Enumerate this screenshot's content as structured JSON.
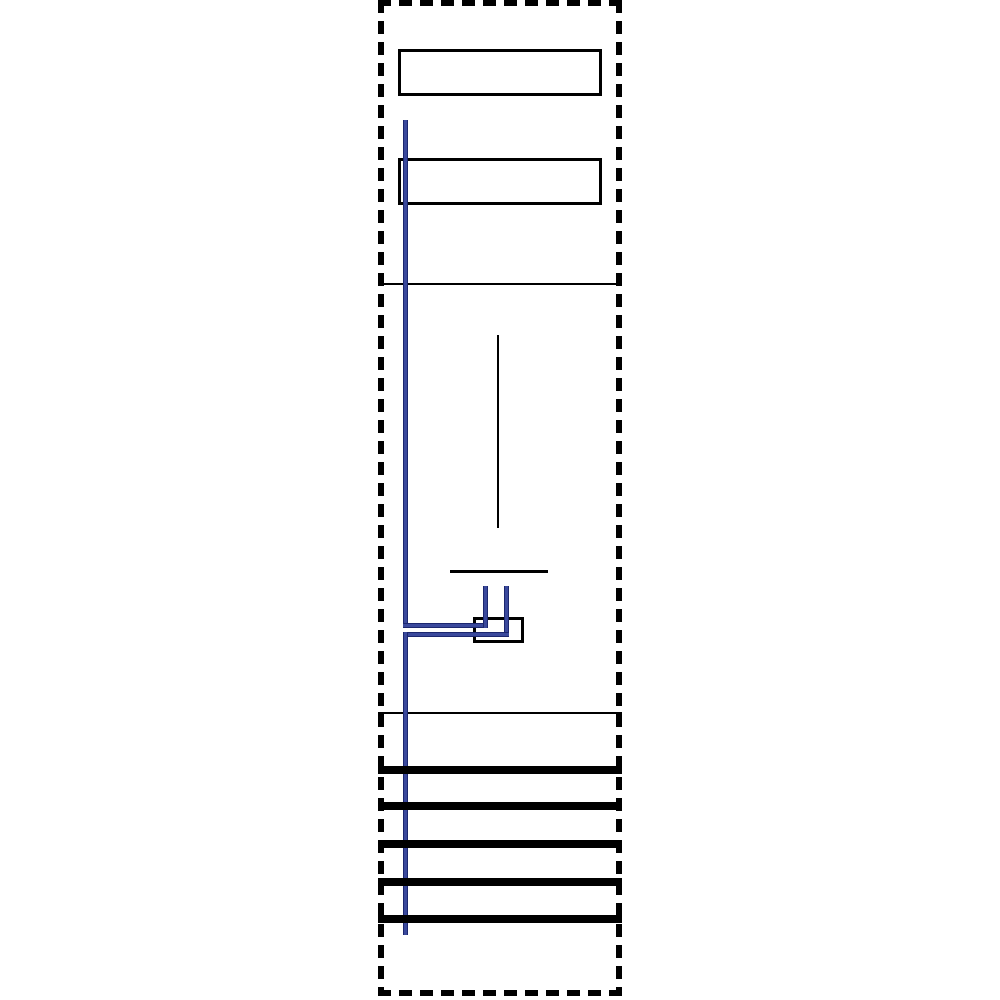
{
  "page": {
    "width": 1000,
    "height": 1000,
    "background": "#ffffff"
  },
  "colors": {
    "line": "#000000",
    "frame": "#000000",
    "box_fill": "#ffffff",
    "wire": "#3a499c",
    "wire_dark": "#1c276f"
  },
  "diagram": {
    "type": "panel-wiring-diagram",
    "elements": [
      {
        "name": "frame-top-dashed-border",
        "type": "dash-h",
        "x": 378,
        "y": 0,
        "w": 244,
        "h": 6
      },
      {
        "name": "frame-bottom-dashed-border",
        "type": "dash-h",
        "x": 378,
        "y": 990,
        "w": 244,
        "h": 6
      },
      {
        "name": "frame-left-dashed-border",
        "type": "dash-v",
        "x": 378,
        "y": 0,
        "w": 6,
        "h": 996
      },
      {
        "name": "frame-right-dashed-border",
        "type": "dash-v",
        "x": 616,
        "y": 0,
        "w": 6,
        "h": 996
      },
      {
        "name": "label-box-top",
        "type": "outline",
        "x": 398,
        "y": 49,
        "w": 204,
        "h": 47,
        "border": 3
      },
      {
        "name": "label-box-middle",
        "type": "outline",
        "x": 398,
        "y": 158,
        "w": 204,
        "h": 47,
        "border": 3
      },
      {
        "name": "divider-line-upper",
        "type": "line",
        "x": 378,
        "y": 283,
        "w": 244,
        "h": 2
      },
      {
        "name": "meter-axis-line",
        "type": "line",
        "x": 497,
        "y": 335,
        "w": 2,
        "h": 193
      },
      {
        "name": "meter-base-line",
        "type": "line",
        "x": 450,
        "y": 570,
        "w": 98,
        "h": 3
      },
      {
        "name": "divider-line-lower",
        "type": "line",
        "x": 378,
        "y": 712,
        "w": 244,
        "h": 2
      },
      {
        "name": "terminal-box",
        "type": "outline",
        "x": 473,
        "y": 617,
        "w": 51,
        "h": 26,
        "border": 3
      },
      {
        "name": "wire-main-upper-vertical",
        "type": "wire-v",
        "x": 403,
        "y": 120,
        "w": 5,
        "h": 508
      },
      {
        "name": "wire-branch-upper-horizontal",
        "type": "wire-h",
        "x": 403,
        "y": 623,
        "w": 85,
        "h": 5
      },
      {
        "name": "wire-stub-left-vertical",
        "type": "wire-v",
        "x": 483,
        "y": 586,
        "w": 5,
        "h": 42
      },
      {
        "name": "wire-stub-right-vertical",
        "type": "wire-v",
        "x": 504,
        "y": 586,
        "w": 5,
        "h": 51
      },
      {
        "name": "wire-branch-lower-horizontal",
        "type": "wire-h",
        "x": 403,
        "y": 632,
        "w": 106,
        "h": 5
      },
      {
        "name": "wire-main-lower-vertical",
        "type": "wire-v",
        "x": 403,
        "y": 632,
        "w": 5,
        "h": 303
      },
      {
        "name": "busbar-1",
        "type": "bar",
        "x": 378,
        "y": 766,
        "w": 244,
        "h": 8
      },
      {
        "name": "busbar-2",
        "type": "bar",
        "x": 378,
        "y": 802,
        "w": 244,
        "h": 8
      },
      {
        "name": "busbar-3",
        "type": "bar",
        "x": 378,
        "y": 840,
        "w": 244,
        "h": 8
      },
      {
        "name": "busbar-4",
        "type": "bar",
        "x": 378,
        "y": 878,
        "w": 244,
        "h": 8
      },
      {
        "name": "busbar-5",
        "type": "bar",
        "x": 378,
        "y": 915,
        "w": 244,
        "h": 8
      }
    ]
  }
}
